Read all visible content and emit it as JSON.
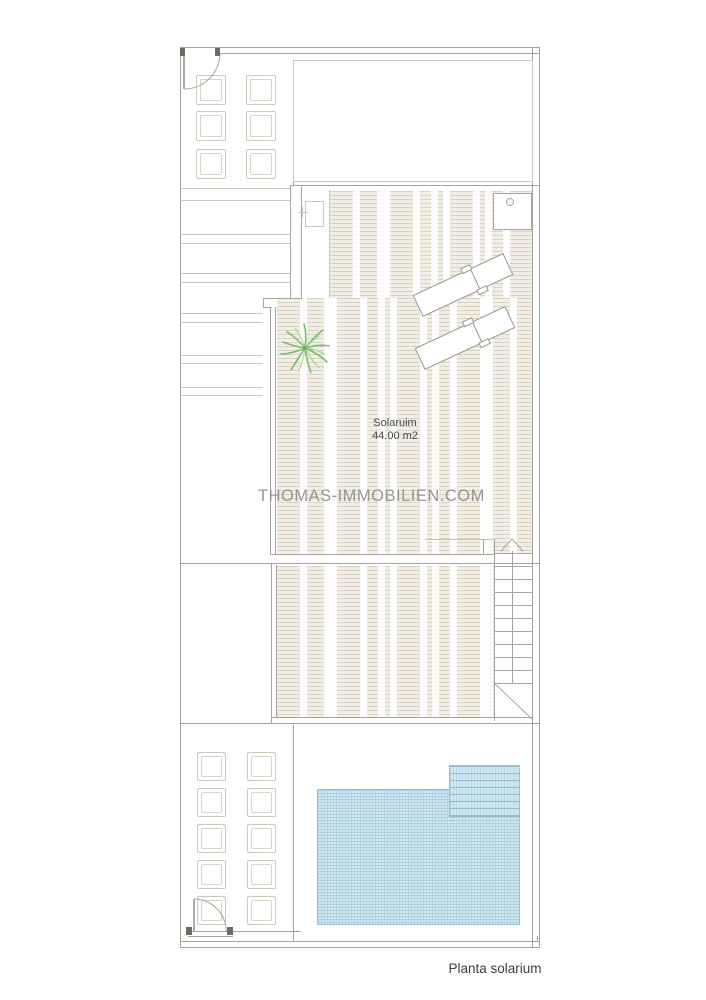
{
  "plan": {
    "caption": "Planta solarium",
    "watermark": "THOMAS-IMMOBILIEN.COM",
    "rooms": [
      {
        "name": "Solaruim",
        "area": "44.00 m2"
      }
    ],
    "features": {
      "staircase": "stairs-with-up-arrow",
      "pool": "tiled-pool-with-steps",
      "deck": "wood-deck-texture",
      "plant": "palm-plant",
      "loungers": 2,
      "doors": 2,
      "pergola_squares_top": 6,
      "pergola_squares_bottom": 10
    }
  },
  "palette": {
    "wall_line": "#a7a39b",
    "light_line": "#cac6bd",
    "deck_bg": "#f1eee6",
    "deck_line": "#ded7c8",
    "pool_fill": "#cfe8f0",
    "pool_line": "#9cbecb",
    "plant_green": "#7cbd6b",
    "text": "#454545",
    "watermark_gray": "#8e8e8e"
  }
}
